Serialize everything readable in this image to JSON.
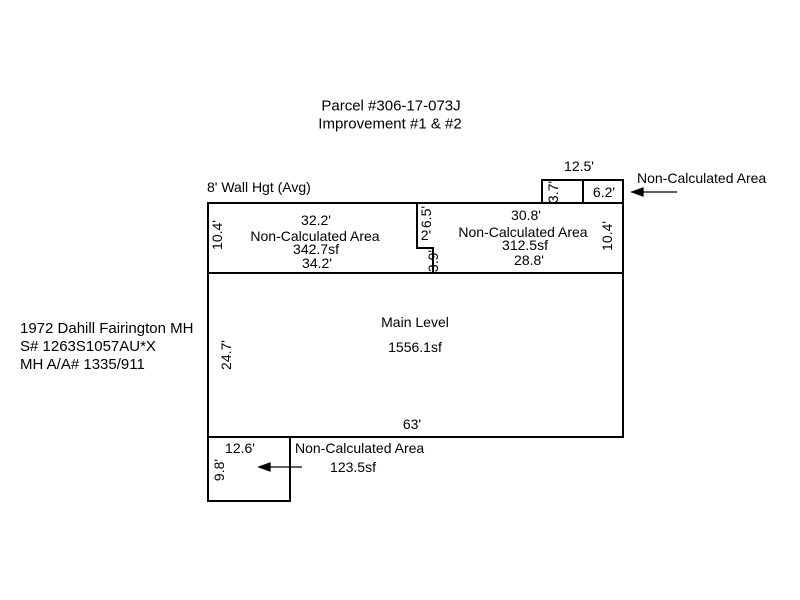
{
  "header": {
    "title_line1": "Parcel #306-17-073J",
    "title_line2": "Improvement #1 & #2"
  },
  "annotations": {
    "wall_height": "8' Wall Hgt (Avg)"
  },
  "property_info": {
    "line1": "1972 Dahill Fairington MH",
    "line2": "S# 1263S1057AU*X",
    "line3": "MH A/A# 1335/911"
  },
  "top_addition": {
    "overall_width": "12.5'",
    "left_cell_height": "3.7'",
    "right_cell_width": "6.2'",
    "callout_label": "Non-Calculated Area"
  },
  "upper_left_area": {
    "top_width": "32.2'",
    "label": "Non-Calculated Area",
    "area": "342.7sf",
    "bottom_width": "34.2'",
    "side_height": "10.4'"
  },
  "notch": {
    "upper_height": "6.5'",
    "step_width": "2'",
    "lower_height": "3.9'"
  },
  "upper_right_area": {
    "top_width": "30.8'",
    "label": "Non-Calculated Area",
    "area": "312.5sf",
    "bottom_width": "28.8'",
    "side_height": "10.4'"
  },
  "main_level": {
    "label": "Main Level",
    "area": "1556.1sf",
    "side_height": "24.7'",
    "bottom_width": "63'"
  },
  "bottom_addition": {
    "top_width": "12.6'",
    "side_height": "9.8'",
    "callout_label": "Non-Calculated Area",
    "area": "123.5sf"
  },
  "colors": {
    "background": "#ffffff",
    "line": "#000000",
    "text": "#000000"
  }
}
